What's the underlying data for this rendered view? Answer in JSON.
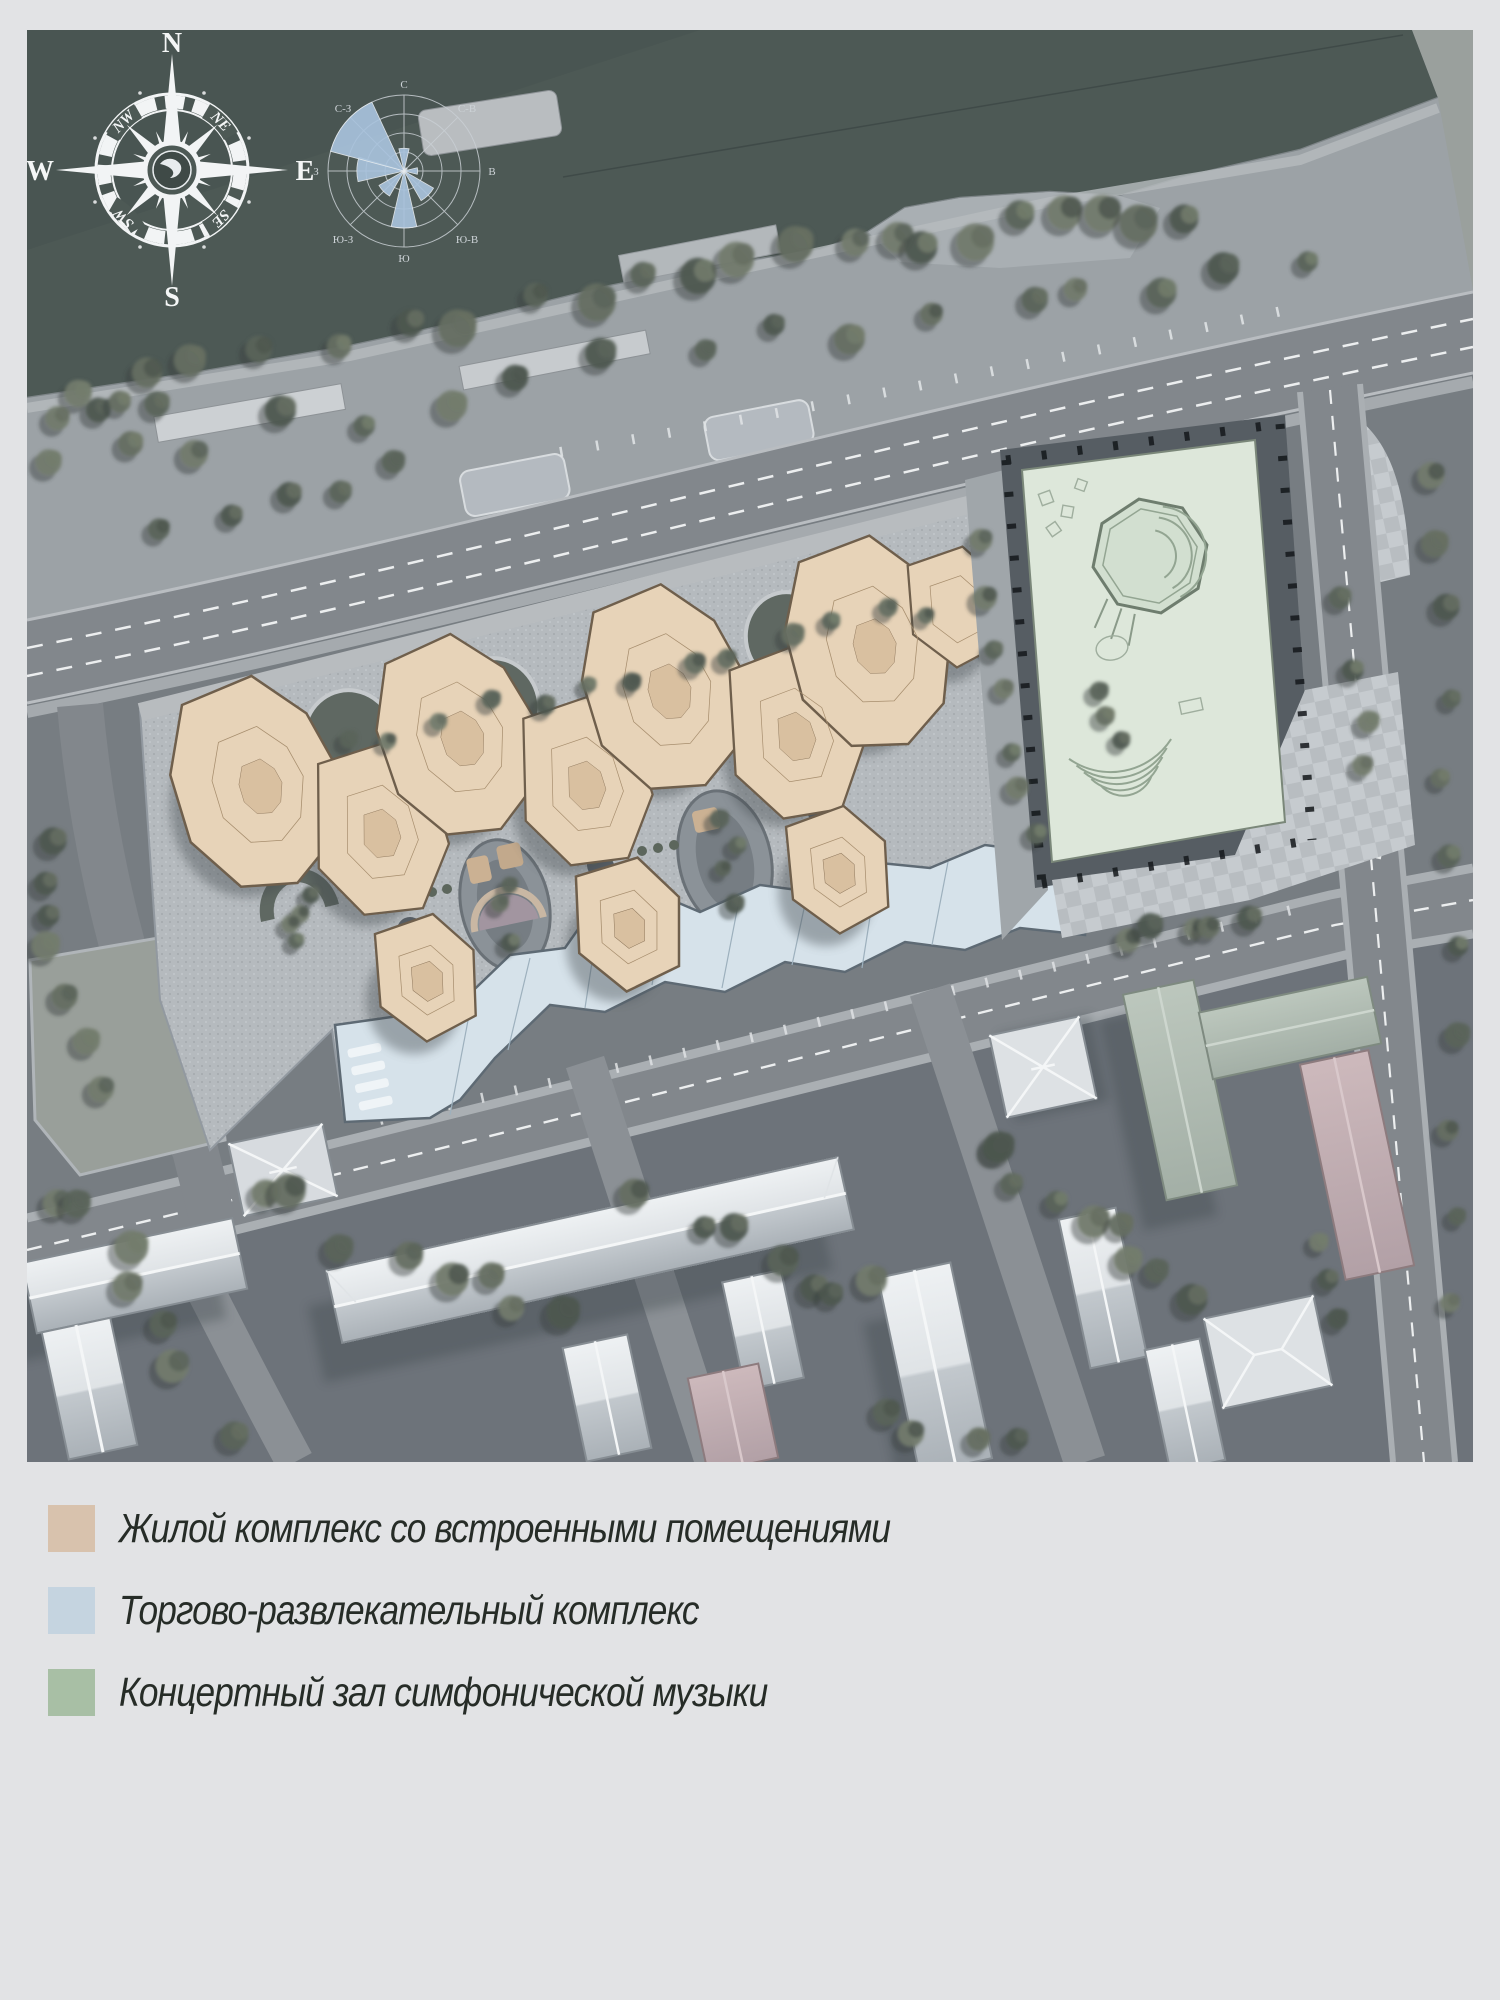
{
  "page": {
    "background": "#e2e3e5"
  },
  "compass": {
    "n": "N",
    "e": "E",
    "s": "S",
    "w": "W",
    "nw": "NW",
    "ne": "NE",
    "sw": "SW",
    "se": "SE"
  },
  "wind_rose": {
    "labels": {
      "n": "С",
      "ne": "С-В",
      "e": "В",
      "se": "Ю-В",
      "s": "Ю",
      "sw": "Ю-З",
      "w": "З",
      "nw": "С-З"
    },
    "petal_color": "#a9c3dd",
    "grid_color": "#c9cfd4",
    "petals": [
      {
        "dir": "N",
        "deg": 0,
        "value": 0.3,
        "spread": 26
      },
      {
        "dir": "NE",
        "deg": 45,
        "value": 0.05,
        "spread": 26
      },
      {
        "dir": "E",
        "deg": 90,
        "value": 0.18,
        "spread": 28
      },
      {
        "dir": "SE",
        "deg": 135,
        "value": 0.45,
        "spread": 30
      },
      {
        "dir": "S",
        "deg": 180,
        "value": 0.75,
        "spread": 26
      },
      {
        "dir": "SW",
        "deg": 225,
        "value": 0.38,
        "spread": 30
      },
      {
        "dir": "W",
        "deg": 272,
        "value": 0.62,
        "spread": 30
      },
      {
        "dir": "NW",
        "deg": 310,
        "value": 1.0,
        "spread": 50
      }
    ]
  },
  "legend": {
    "items": [
      {
        "label": "Жилой комплекс со встроенными помещениями",
        "color": "#d8c2ad"
      },
      {
        "label": "Торгово-развлекательный комплекс",
        "color": "#c5d4e0"
      },
      {
        "label": "Концертный зал симфонической музыки",
        "color": "#a8bfa5"
      }
    ]
  },
  "map_colors": {
    "water": "#4d5955",
    "land": "#777d82",
    "road": "#82878c",
    "residential": "#e7d3b8",
    "retail": "#d6e2ea",
    "concert_hall": "#dde7da"
  }
}
